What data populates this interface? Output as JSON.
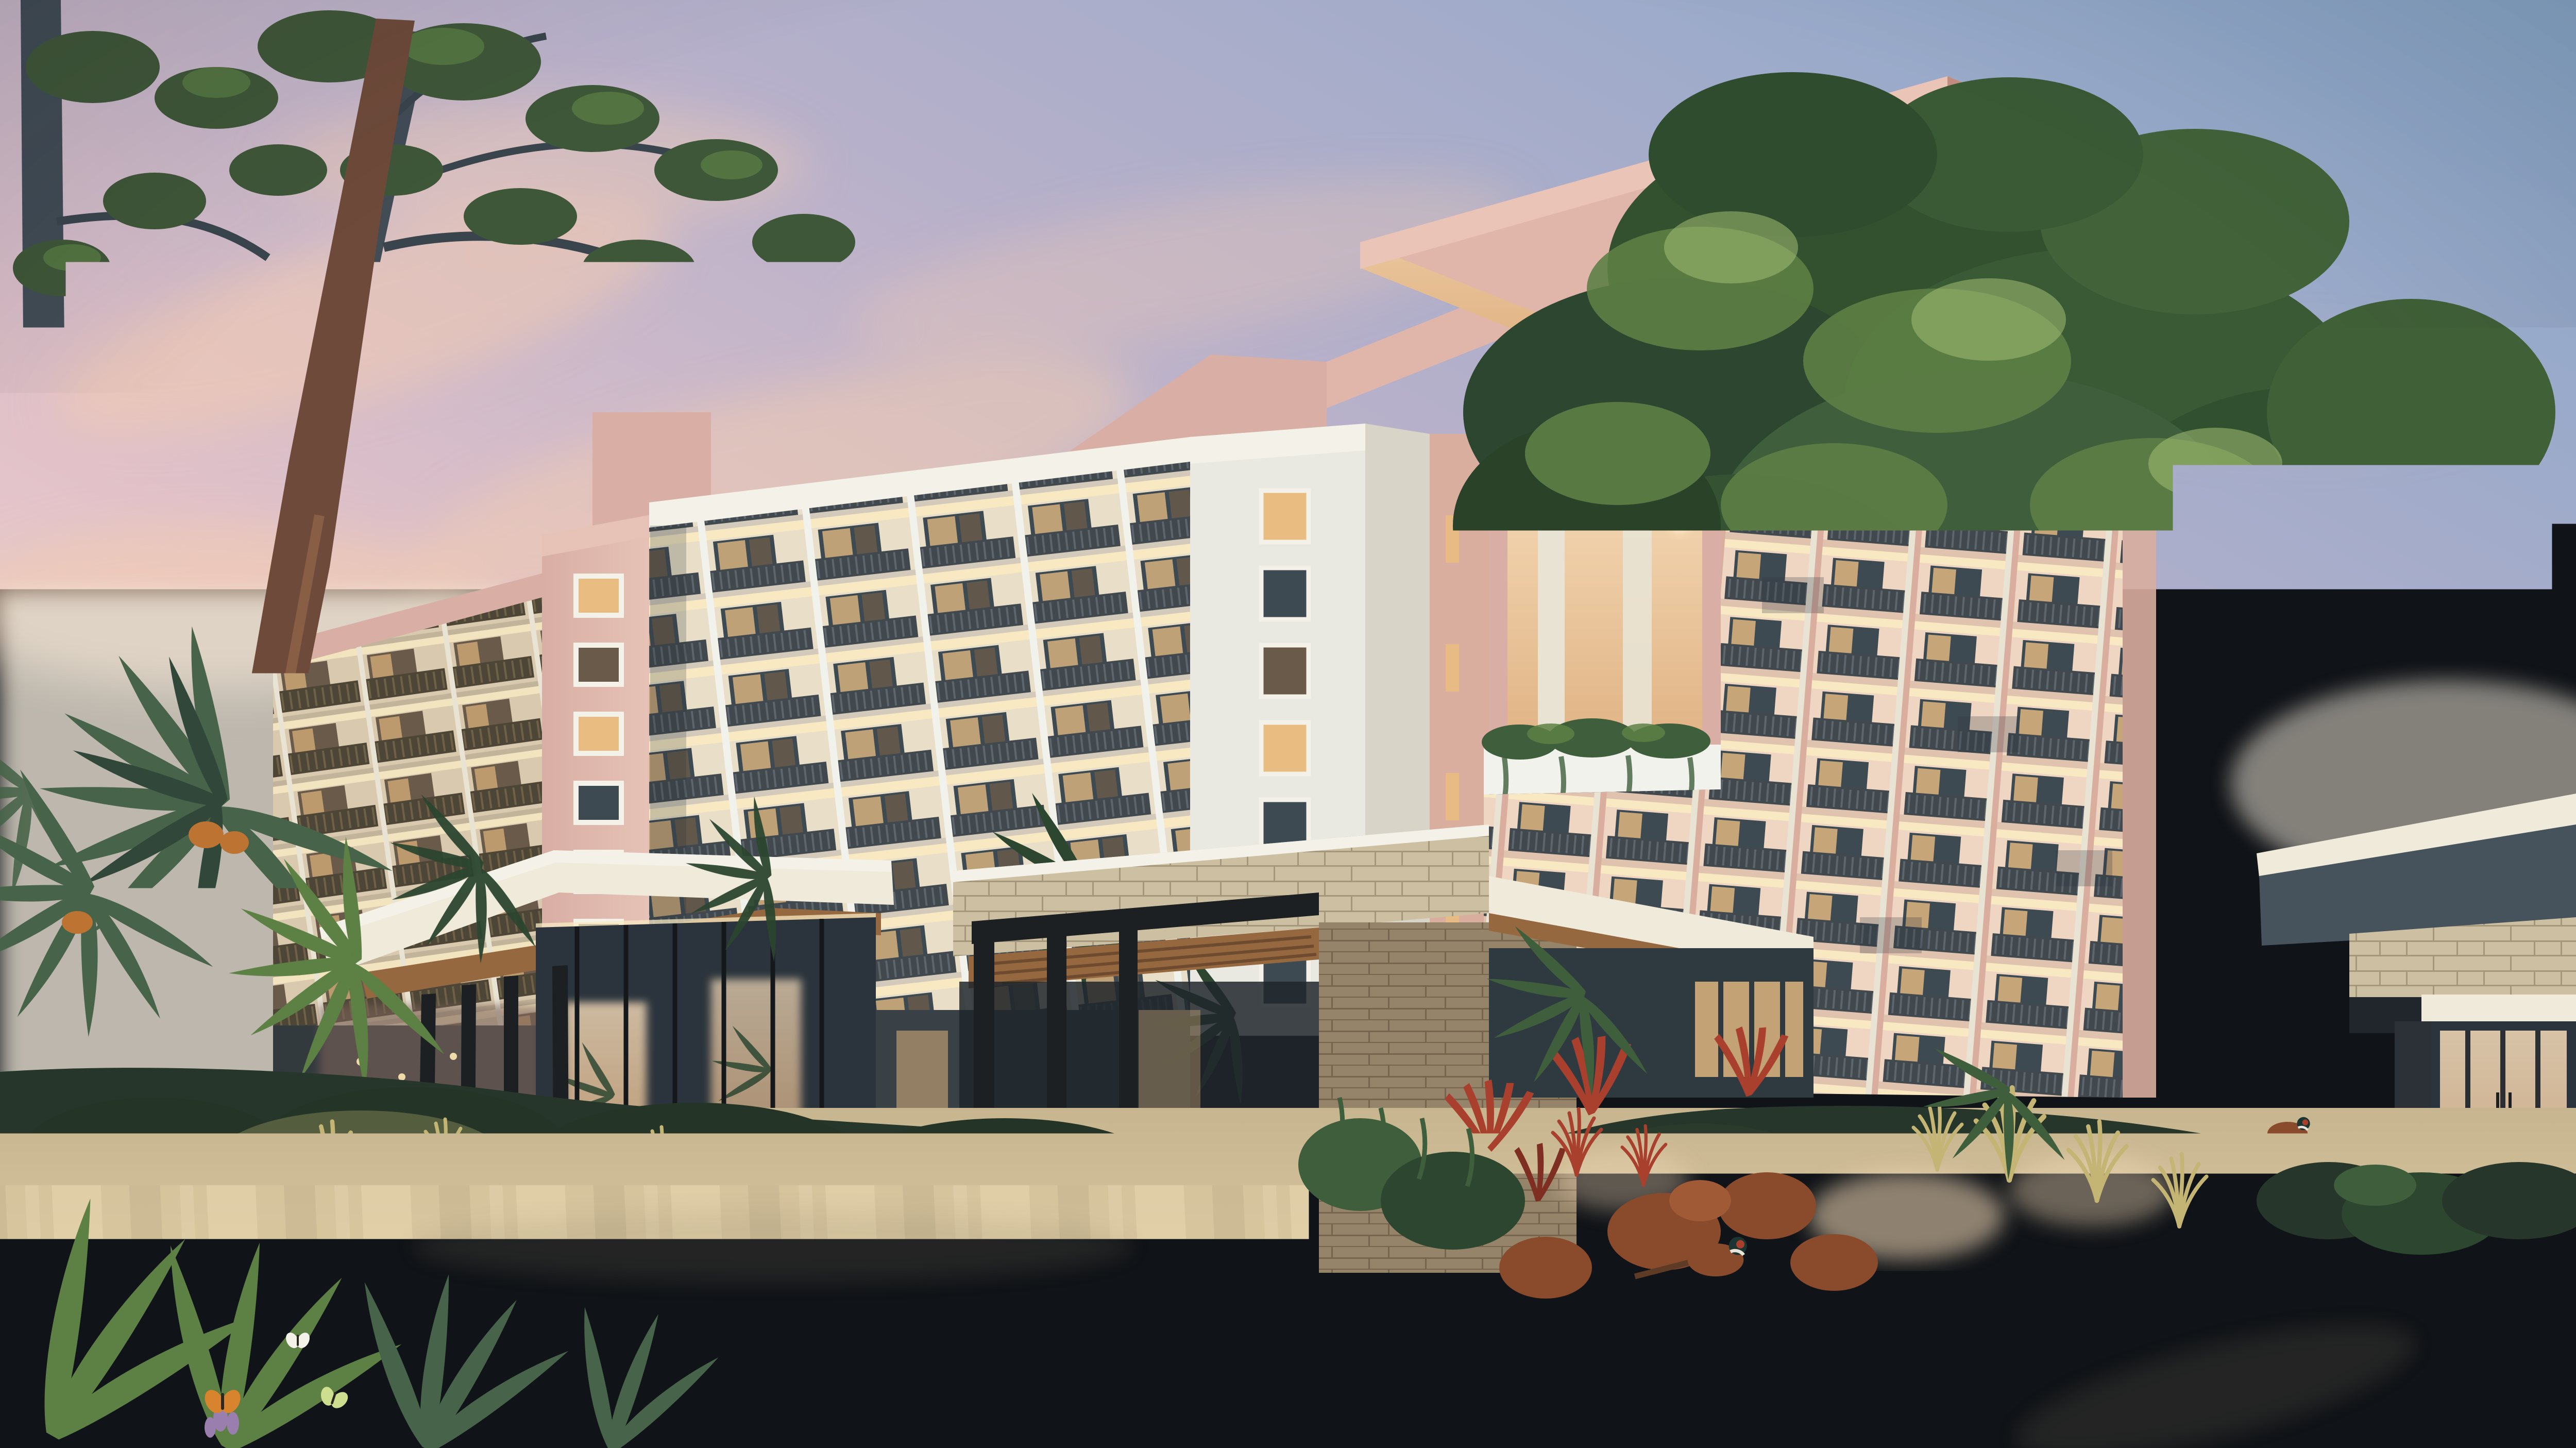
{
  "scene": {
    "kind": "architectural-dusk-rendering",
    "subject": "resort hotel with balconied wings, cantilevered pink roof, entry canopies, tropical landscaping and paver driveway at sunset",
    "counts": {
      "left_block_floors": 8,
      "right_tower_floors": 9,
      "stair_tower_windows": 6,
      "roof_columns": 4,
      "palm_heads": 8,
      "butterflies": 3,
      "pheasants": 2,
      "garden_chairs": 2
    }
  },
  "palette": {
    "sky_top": "#87a6c9",
    "sky_mid": "#b6b0ca",
    "sky_pink": "#e2c2c9",
    "sky_cream": "#f5e3d2",
    "cloud": "#f2cbb0",
    "horizon_glow": "#f7efe0",
    "facade_cream": "#e9dfc8",
    "wing_wall": "#d9c9ae",
    "bay_cream": "#eed6c2",
    "soffit_glow": "#f8e9c3",
    "railing": "#41484e",
    "railing_light": "#5d666d",
    "railing_bronze": "#4d4536",
    "railing_bronze_light": "#6d6148",
    "fin_white": "#f1f2ec",
    "fin_warm": "#e8e3d2",
    "slab": "#d3cabb",
    "slab_pink": "#e0c3ae",
    "slab_wing": "#c2b49a",
    "window_dark": "#3e4a52",
    "window_warm": "#e9bd82",
    "window_dim": "#6a5a49",
    "pink_wall": "#d9aea4",
    "pink_light": "#e6c3b6",
    "pink_pier": "#d9ae9f",
    "roof_top": "#e0b6aa",
    "roof_edge": "#eac4b6",
    "roof_shadow": "#c08d80",
    "tower_white": "#e9e8e1",
    "tower_side": "#d8d4c7",
    "warm_glow": "#f6dcba",
    "warm_deep": "#e0b384",
    "stone": "#cdc0a2",
    "stone_dark": "#a4977b",
    "brick": "#b9a584",
    "brick_joint": "#8f7c60",
    "steel": "#1c2023",
    "wood": "#96683f",
    "wood_dark": "#744e2f",
    "canopy_white": "#f0eadb",
    "glass_dark": "#2b343c",
    "green_dark": "#2c4630",
    "green_mid": "#3f5e3c",
    "green_light": "#5d8045",
    "green_lit": "#a3bd72",
    "palm_green": "#47644a",
    "bed_dark": "#26362a",
    "trunk_slate": "#414c55",
    "trunk_red": "#6e4a3a",
    "trunk_tan": "#c1976d",
    "trunk_shadow": "#7c5a3e",
    "grass_gold": "#c5b574",
    "flower_red": "#a9402e",
    "shrub_rust": "#8a4a2c",
    "flower_purple": "#9a7fae",
    "butterfly_orange": "#d8842e",
    "butterfly_green": "#cede8f",
    "paving": "#d8c69f",
    "paving_light": "#e7d6ae",
    "paving_dark": "#c7b590",
    "paving_shadow": "#8a7f68",
    "curb_stone": "#d9cec2",
    "trim_bright": "#f4f1e8",
    "light_warm": "#ffe9b4"
  }
}
